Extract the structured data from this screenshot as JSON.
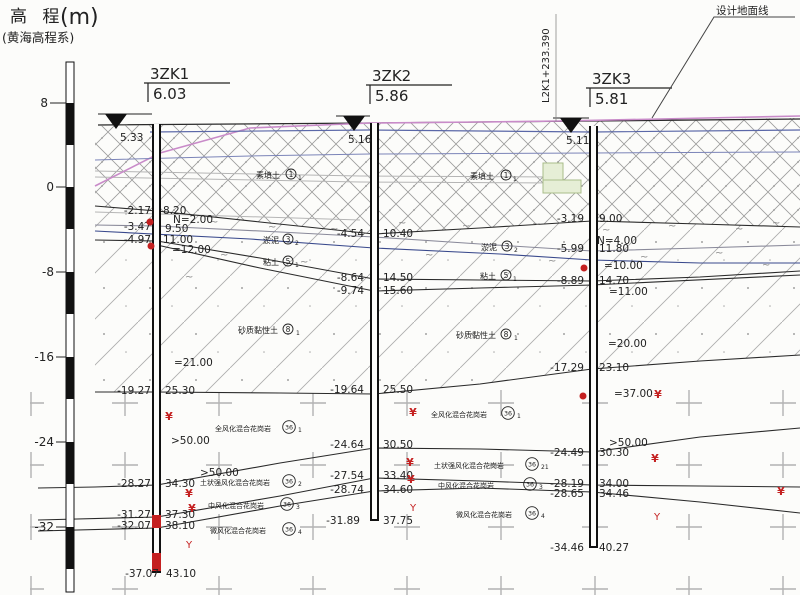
{
  "axis": {
    "title": "高 程",
    "unit": "(m)",
    "subtitle": "(黄海高程系)",
    "ticks": [
      "8",
      "0",
      "-8",
      "-16",
      "-24",
      "-32"
    ]
  },
  "annotations": {
    "station": "L2K1+233.390",
    "design_ground": "设计地面线"
  },
  "boreholes": [
    {
      "name": "3ZK1",
      "top_elev": "6.03",
      "water_level": "5.33",
      "pairs": [
        [
          "-2.17",
          "8.20"
        ],
        [
          "-3.47",
          "9.50"
        ],
        [
          "-4.97",
          "11.00"
        ],
        [
          "-19.27",
          "25.30"
        ],
        [
          "-28.27",
          "34.30"
        ],
        [
          "-31.27",
          "37.30"
        ],
        [
          "-32.07",
          "38.10"
        ],
        [
          "-37.07",
          "43.10"
        ]
      ],
      "spt": [
        "N=2.00",
        "=12.00",
        "=21.00",
        ">50.00",
        ">50.00"
      ]
    },
    {
      "name": "3ZK2",
      "top_elev": "5.86",
      "water_level": "5.16",
      "pairs": [
        [
          "-4.54",
          "10.40"
        ],
        [
          "-8.64",
          "14.50"
        ],
        [
          "-9.74",
          "15.60"
        ],
        [
          "-19.64",
          "25.50"
        ],
        [
          "-24.64",
          "30.50"
        ],
        [
          "-27.54",
          "33.40"
        ],
        [
          "-28.74",
          "34.60"
        ],
        [
          "-31.89",
          "37.75"
        ]
      ],
      "spt": []
    },
    {
      "name": "3ZK3",
      "top_elev": "5.81",
      "water_level": "5.11",
      "pairs": [
        [
          "-3.19",
          "9.00"
        ],
        [
          "-5.99",
          "11.80"
        ],
        [
          "-8.89",
          "14.70"
        ],
        [
          "-17.29",
          "23.10"
        ],
        [
          "-24.49",
          "30.30"
        ],
        [
          "-28.19",
          "34.00"
        ],
        [
          "-28.65",
          "34.46"
        ],
        [
          "-34.46",
          "40.27"
        ]
      ],
      "spt": [
        "N=4.00",
        "=10.00",
        "=11.00",
        "=20.00",
        "=37.00",
        ">50.00"
      ]
    }
  ],
  "strata": [
    {
      "label": "素填土",
      "num": "1",
      "sub": "1"
    },
    {
      "label": "淤泥",
      "num": "3",
      "sub": "2"
    },
    {
      "label": "粘土",
      "num": "5",
      "sub": "1"
    },
    {
      "label": "砂质黏性土",
      "num": "8",
      "sub": "1"
    },
    {
      "label": "全风化混合花岗岩",
      "num": "36",
      "sub": "1"
    },
    {
      "label": "土状强风化混合花岗岩",
      "num": "36",
      "sub": "2"
    },
    {
      "label": "土状强风化混合花岗岩",
      "num": "36",
      "sub": "21"
    },
    {
      "label": "中风化混合花岗岩",
      "num": "36",
      "sub": "3"
    },
    {
      "label": "微风化混合花岗岩",
      "num": "36",
      "sub": "4"
    }
  ],
  "marks": {
    "spt_mark": "¥",
    "core_mark": "Y",
    "seam_mark": "~"
  },
  "colors": {
    "design_line": "#c98bc9",
    "water_line": "#5b68a8",
    "sample_red": "#c42020"
  }
}
